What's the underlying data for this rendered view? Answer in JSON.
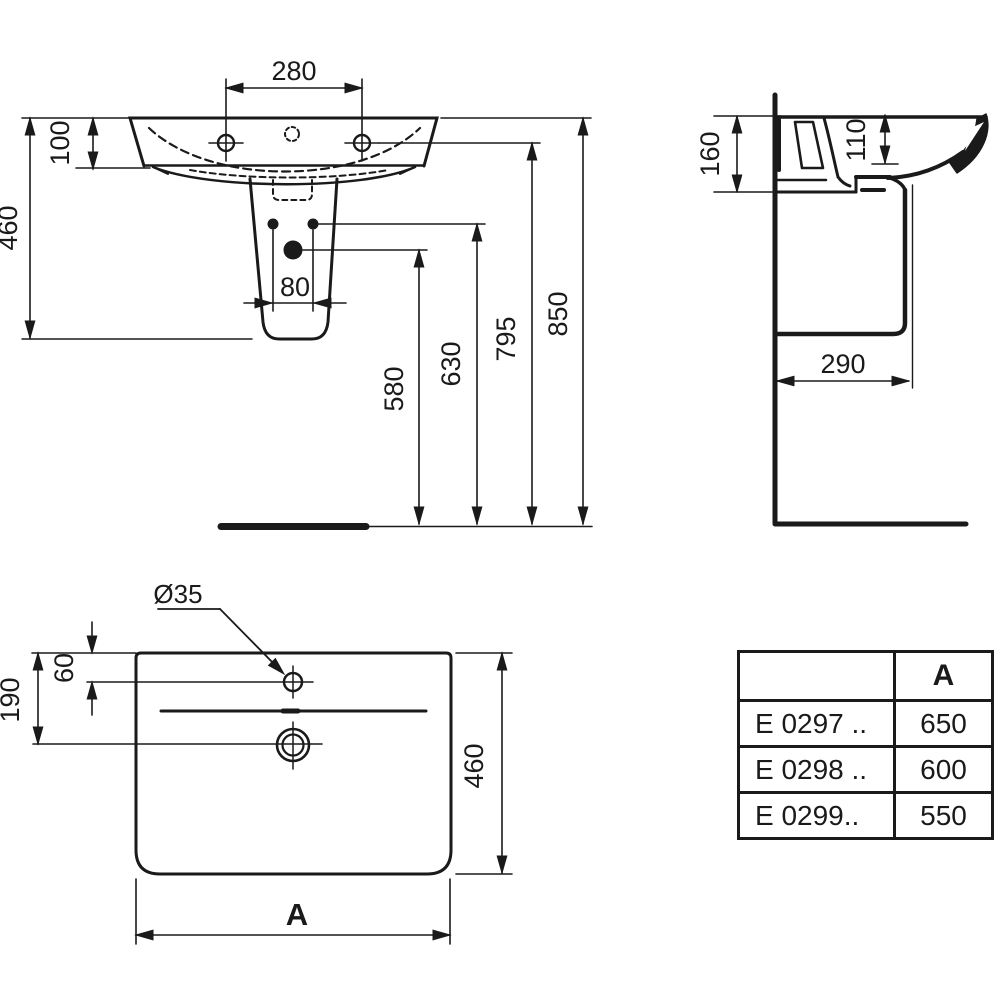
{
  "drawing": {
    "front_view": {
      "dim_width_280": "280",
      "dim_depth_100": "100",
      "dim_height_460": "460",
      "dim_holes_80": "80",
      "dim_h_580": "580",
      "dim_h_630": "630",
      "dim_h_795": "795",
      "dim_h_850": "850"
    },
    "side_view": {
      "dim_160": "160",
      "dim_110": "110",
      "dim_290": "290"
    },
    "top_view": {
      "hole_diameter": "Ø35",
      "dim_60": "60",
      "dim_190": "190",
      "dim_460": "460",
      "width_label": "A"
    },
    "table": {
      "header_a": "A",
      "rows": [
        {
          "model": "E 0297 ..",
          "a": "650"
        },
        {
          "model": "E 0298 ..",
          "a": "600"
        },
        {
          "model": "E 0299..",
          "a": "550"
        }
      ]
    }
  },
  "colors": {
    "ink": "#1a1a1a",
    "paper": "#ffffff"
  }
}
